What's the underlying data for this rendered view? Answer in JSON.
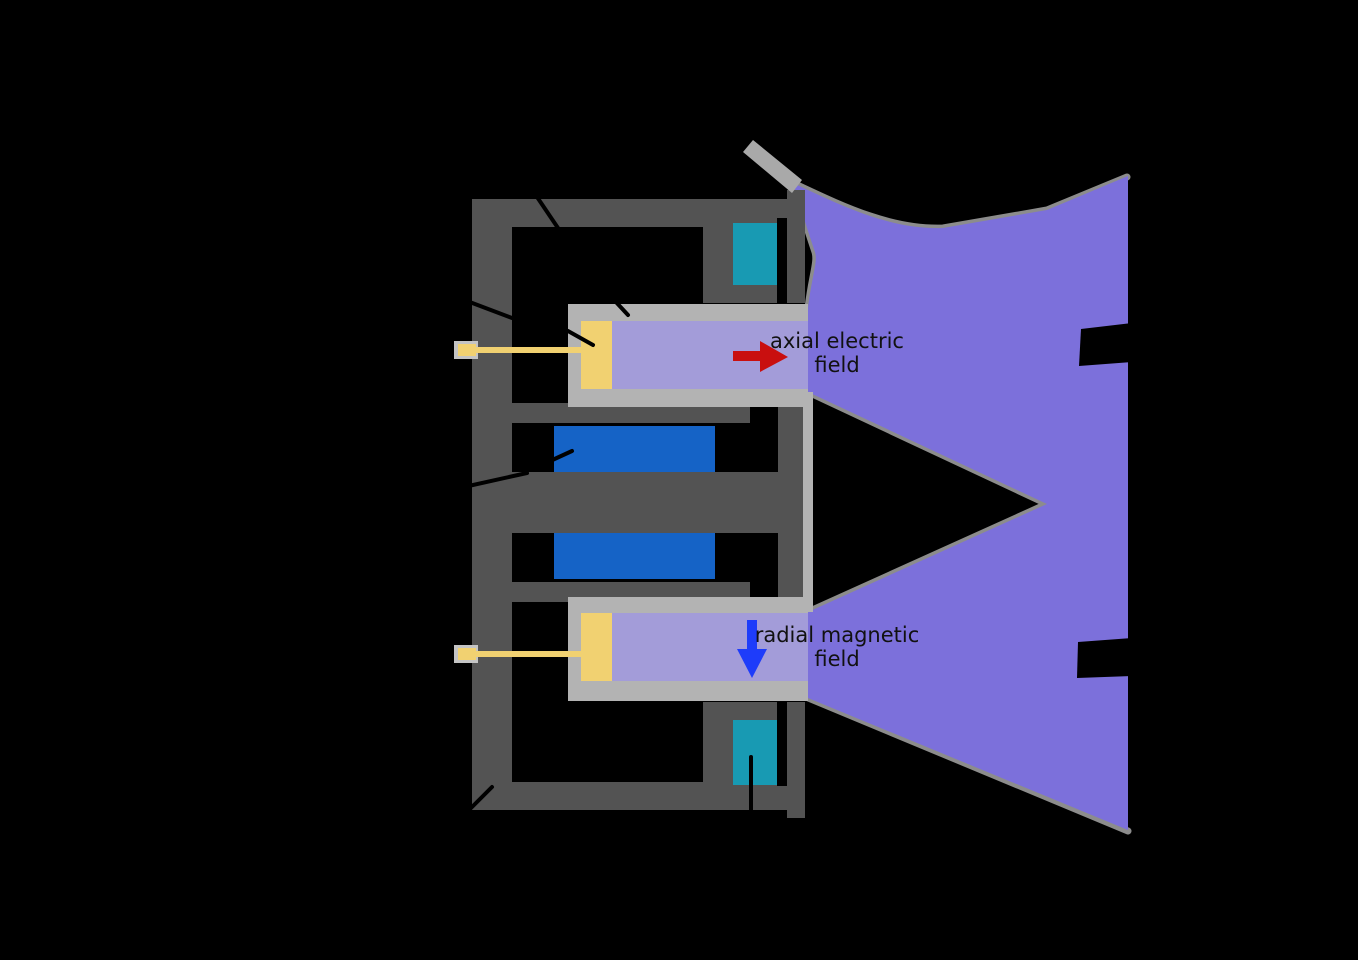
{
  "labels": {
    "axial_field": {
      "line1": "axial electric",
      "line2": "field",
      "arrow_direction": "right"
    },
    "radial_field": {
      "line1": "radial magnetic",
      "line2": "field",
      "arrow_direction": "down"
    }
  },
  "colors": {
    "background": "#000000",
    "magnetic_circuit": "#535353",
    "channel_wall": "#b3b3b3",
    "feed_pad": "#c4c4c4",
    "channel_interior": "#a39cd9",
    "plume": "#7c70db",
    "plume_edge": "#8c8c8c",
    "outer_coil": "#189ab3",
    "inner_coil": "#1563c6",
    "anode": "#f1d171",
    "cathode": "#a9a9a9",
    "electric_arrow": "#c90f0f",
    "magnetic_arrow": "#1e3cfa",
    "leader_line": "#000000",
    "label_text": "#111111"
  }
}
